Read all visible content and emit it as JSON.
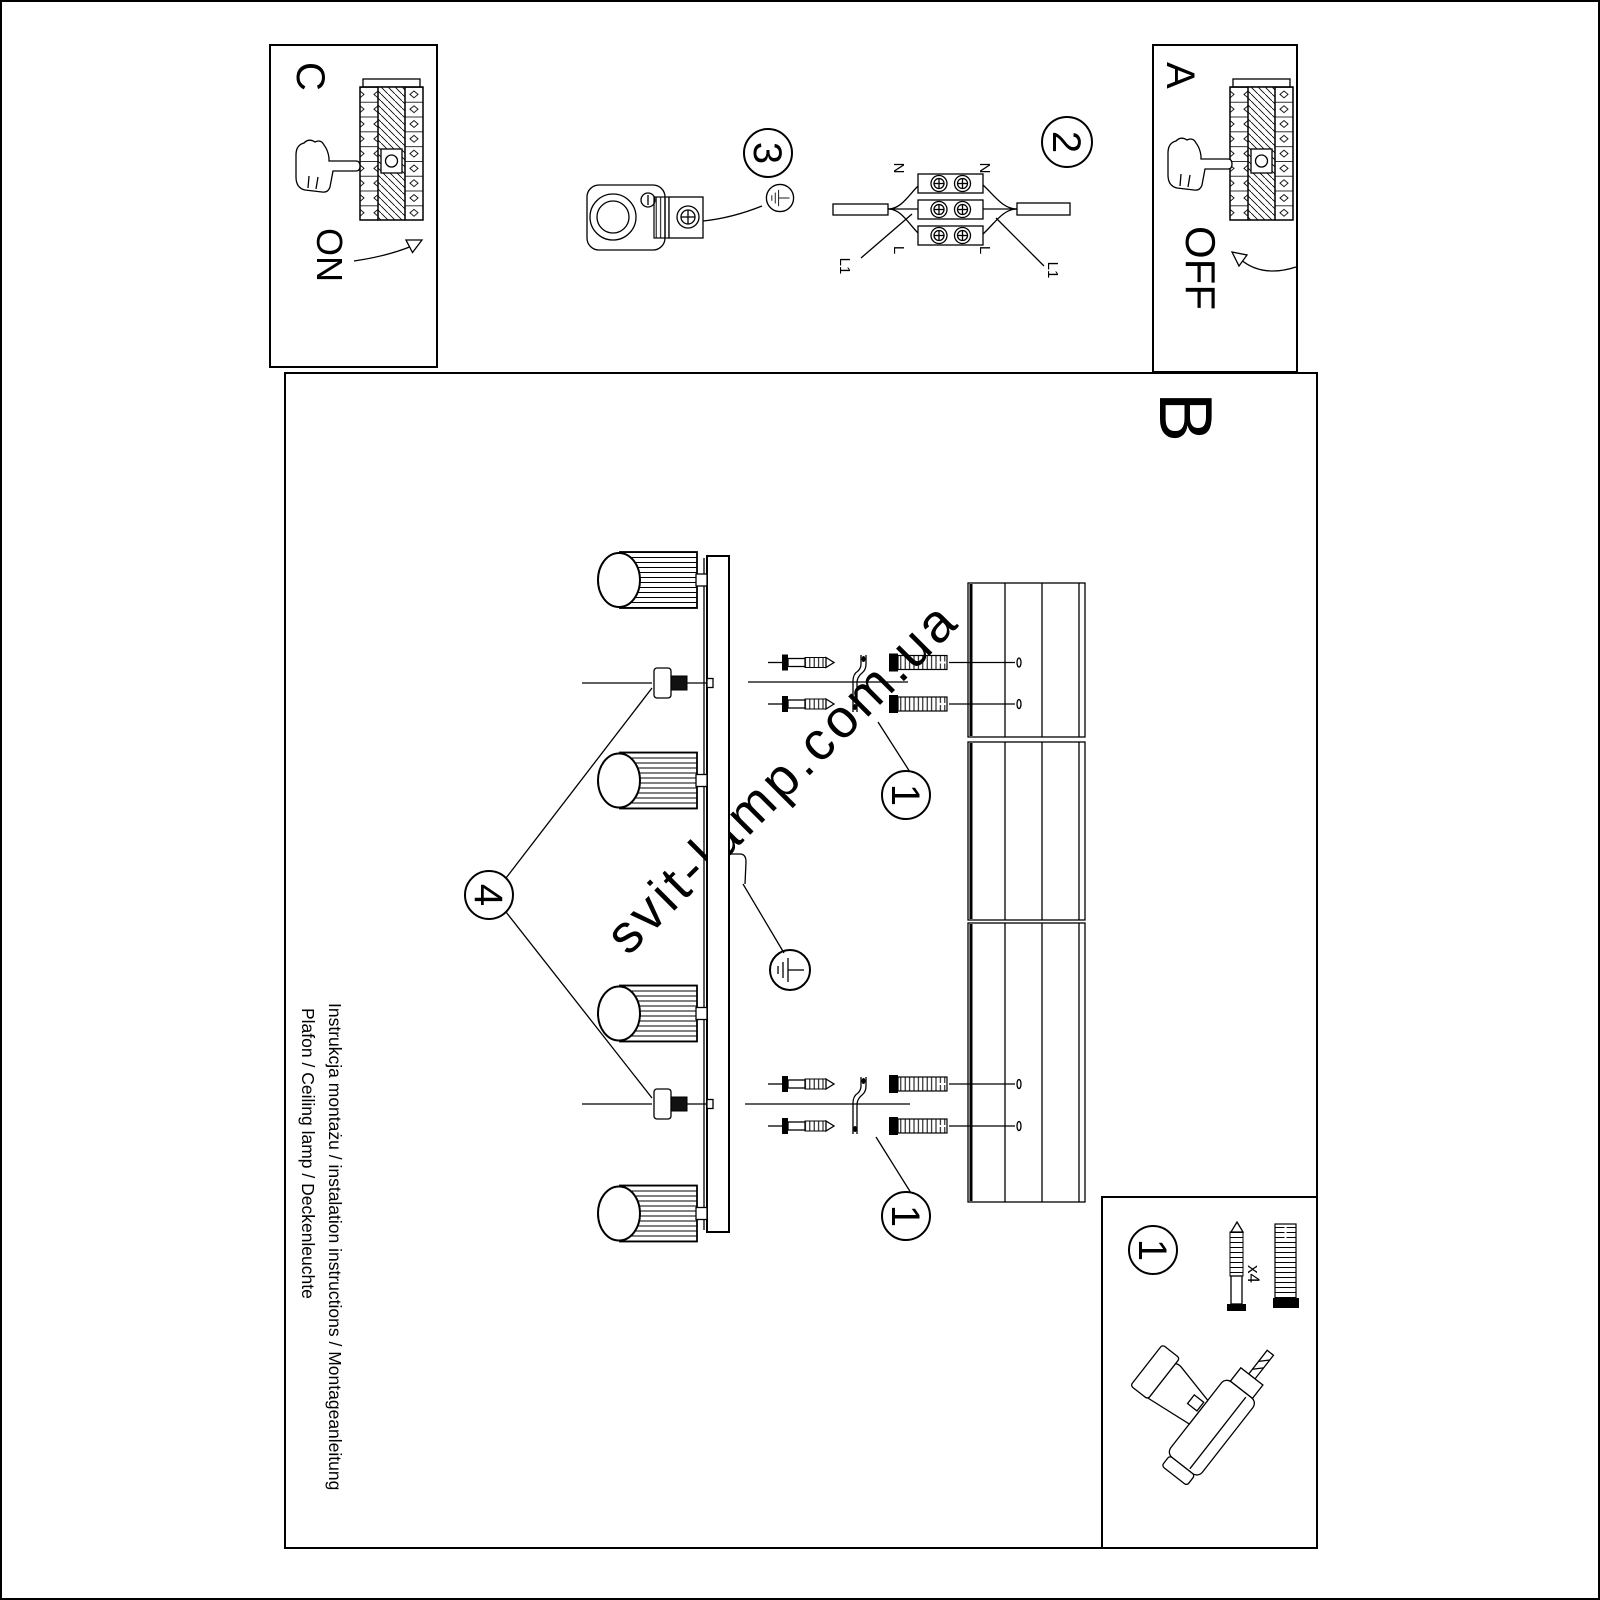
{
  "colors": {
    "ink": "#000000",
    "paper": "#ffffff",
    "watermark": "#cdcdcd"
  },
  "icons": {
    "hand": "pointing-hand",
    "ground": "earth-ground-symbol",
    "drill": "power-drill",
    "breaker": "fuse-box-switch"
  },
  "sheet": {
    "steps": {
      "a": {
        "label": "A",
        "action": "OFF"
      },
      "b": {
        "label": "B"
      },
      "c": {
        "label": "C",
        "action": "ON"
      }
    },
    "badges": {
      "two": "2",
      "three": "3",
      "four": "4",
      "one_hardware_top": "1",
      "one_hardware_bottom": "1",
      "one_parts": "1"
    },
    "wiring": {
      "n_top": "N",
      "n_bottom": "N",
      "l_top": "L",
      "l_bottom": "L",
      "l1_top": "L1",
      "l1_bottom": "L1"
    },
    "parts": {
      "qty": "x4"
    },
    "footer": {
      "line1": "Instrukcja montażu / instalation instructions / Montageanleitung",
      "line2": "Plafon / Ceiling lamp / Deckenleuchte"
    },
    "watermark": {
      "text": "svit-lamp.com.ua"
    }
  }
}
